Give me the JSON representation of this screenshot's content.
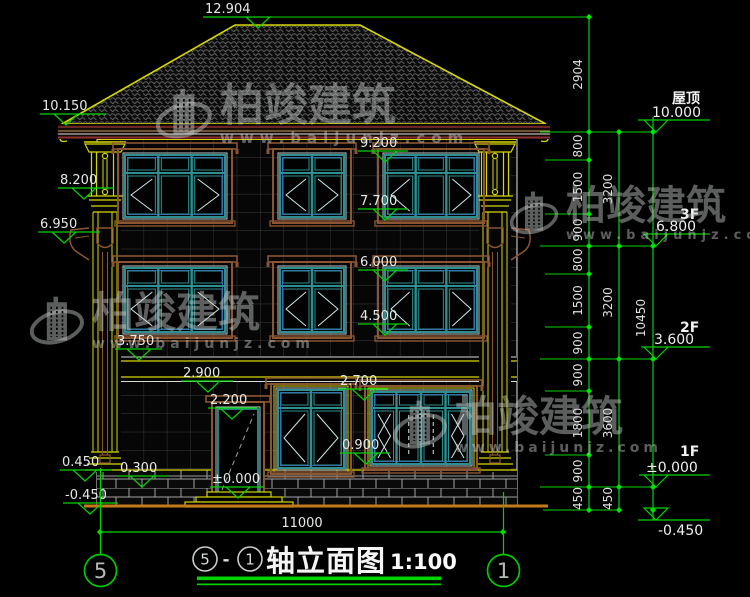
{
  "watermark": {
    "brand": "柏竣建筑",
    "site": "www.baijunjz.com"
  },
  "elevations_left": [
    "12.904",
    "10.150",
    "8.200",
    "6.950",
    "9.200",
    "7.700",
    "6.000",
    "4.500",
    "3.750",
    "2.900",
    "2.200",
    "2.700",
    "0.900",
    "±0.000",
    "0.450",
    "0.300",
    "-0.450"
  ],
  "levels_right": [
    {
      "floor": "屋顶",
      "value": "10.000"
    },
    {
      "floor": "3F",
      "value": "6.800"
    },
    {
      "floor": "2F",
      "value": "3.600"
    },
    {
      "floor": "1F",
      "value": "±0.000"
    },
    {
      "floor": "",
      "value": "-0.450"
    }
  ],
  "dim_chains": {
    "inner": [
      "2904",
      "800",
      "1500",
      "900",
      "800",
      "1500",
      "900",
      "900",
      "1800",
      "900",
      "450"
    ],
    "middle": [
      "3200",
      "3200",
      "3600",
      "450"
    ],
    "overall_height": "10450",
    "overall_width": "11000"
  },
  "axis_grid": {
    "left_bubble": "5",
    "right_bubble": "1"
  },
  "title_block": {
    "axis_from": "5",
    "separator": "-",
    "axis_to": "1",
    "title": "轴立面图",
    "scale": "1:100"
  },
  "colors": {
    "dimension_green": "#00d400",
    "cad_yellow": "#d6d600",
    "window_teal": "#2d8f8f",
    "surround_brown": "#8a5530",
    "ground_orange": "#c47a1a",
    "text_white": "#e6eae6"
  }
}
